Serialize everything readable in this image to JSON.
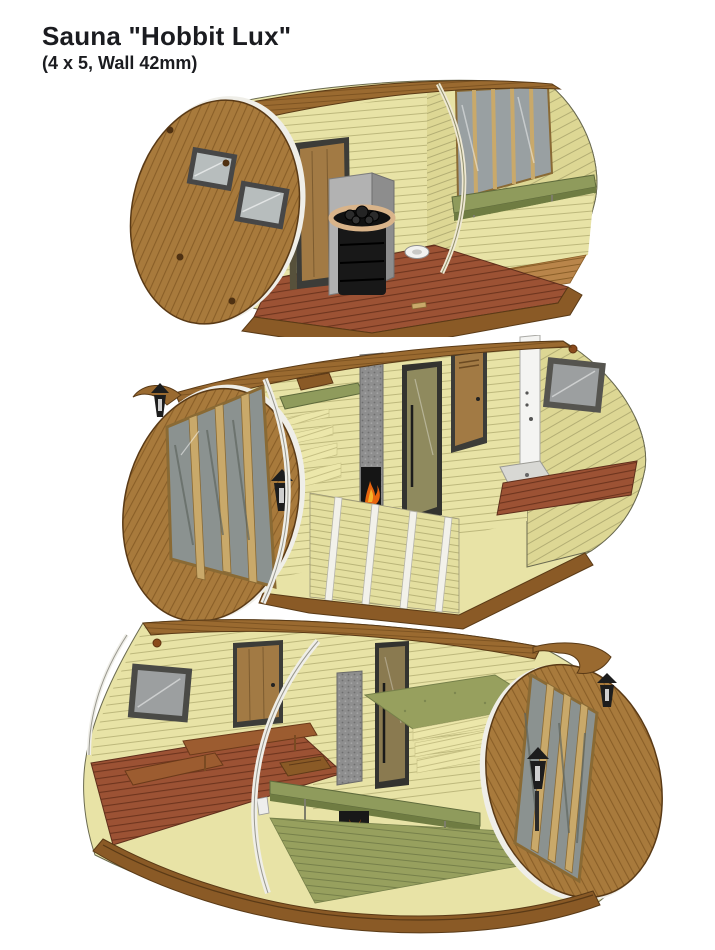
{
  "header": {
    "title": "Sauna \"Hobbit Lux\"",
    "subtitle": "(4 x 5, Wall 42mm)"
  },
  "product": {
    "name": "Hobbit Lux",
    "category": "Sauna",
    "footprint": "4 x 5",
    "wall_thickness": "42mm"
  },
  "views": [
    {
      "name": "cutaway-view-entrance-room-and-heater",
      "features": [
        "barrel end cap with two windows",
        "wooden entrance door",
        "sauna heater with stones",
        "grey heat shield",
        "red terrace deck with sink bowl",
        "glazed folding doors",
        "green wall bench"
      ]
    },
    {
      "name": "cutaway-view-fireplace-benches-and-shower",
      "features": [
        "glazed folding door end",
        "wall lanterns",
        "tiered benches with green tops and wooden headrest",
        "stone chimney with fireplace",
        "glass sauna door",
        "interior wooden door",
        "white shower column",
        "shower tray",
        "grey window",
        "red deck floor",
        "white cut-edge ribs"
      ]
    },
    {
      "name": "cutaway-view-relax-room-and-sauna-benches",
      "features": [
        "grey window",
        "corner wooden bench",
        "wooden door",
        "stone chimney",
        "glass sauna door",
        "green bench with wooden headrest",
        "wood-fired stove",
        "olive lounging mattress",
        "glazed folding door end",
        "wall lanterns"
      ]
    }
  ],
  "palette": {
    "background": "#ffffff",
    "title_color": "#1b1c20",
    "wood": "#a87a3c",
    "wood_dark": "#8a5a26",
    "roof": "#9a6a30",
    "siding": "#e8e3a6",
    "siding_line": "#bdb87c",
    "deck_red": "#9c5234",
    "bench_green": "#8f9b5c",
    "mattress_olive": "#97a05e",
    "stove_black": "#181818",
    "metal_grey": "#8e8e8e",
    "glass_grey": "#99a0a2",
    "door_tan": "#a27a44",
    "frame_dark": "#3c3c38",
    "fire_orange": "#e8650f",
    "rim_white": "#efeee8"
  }
}
